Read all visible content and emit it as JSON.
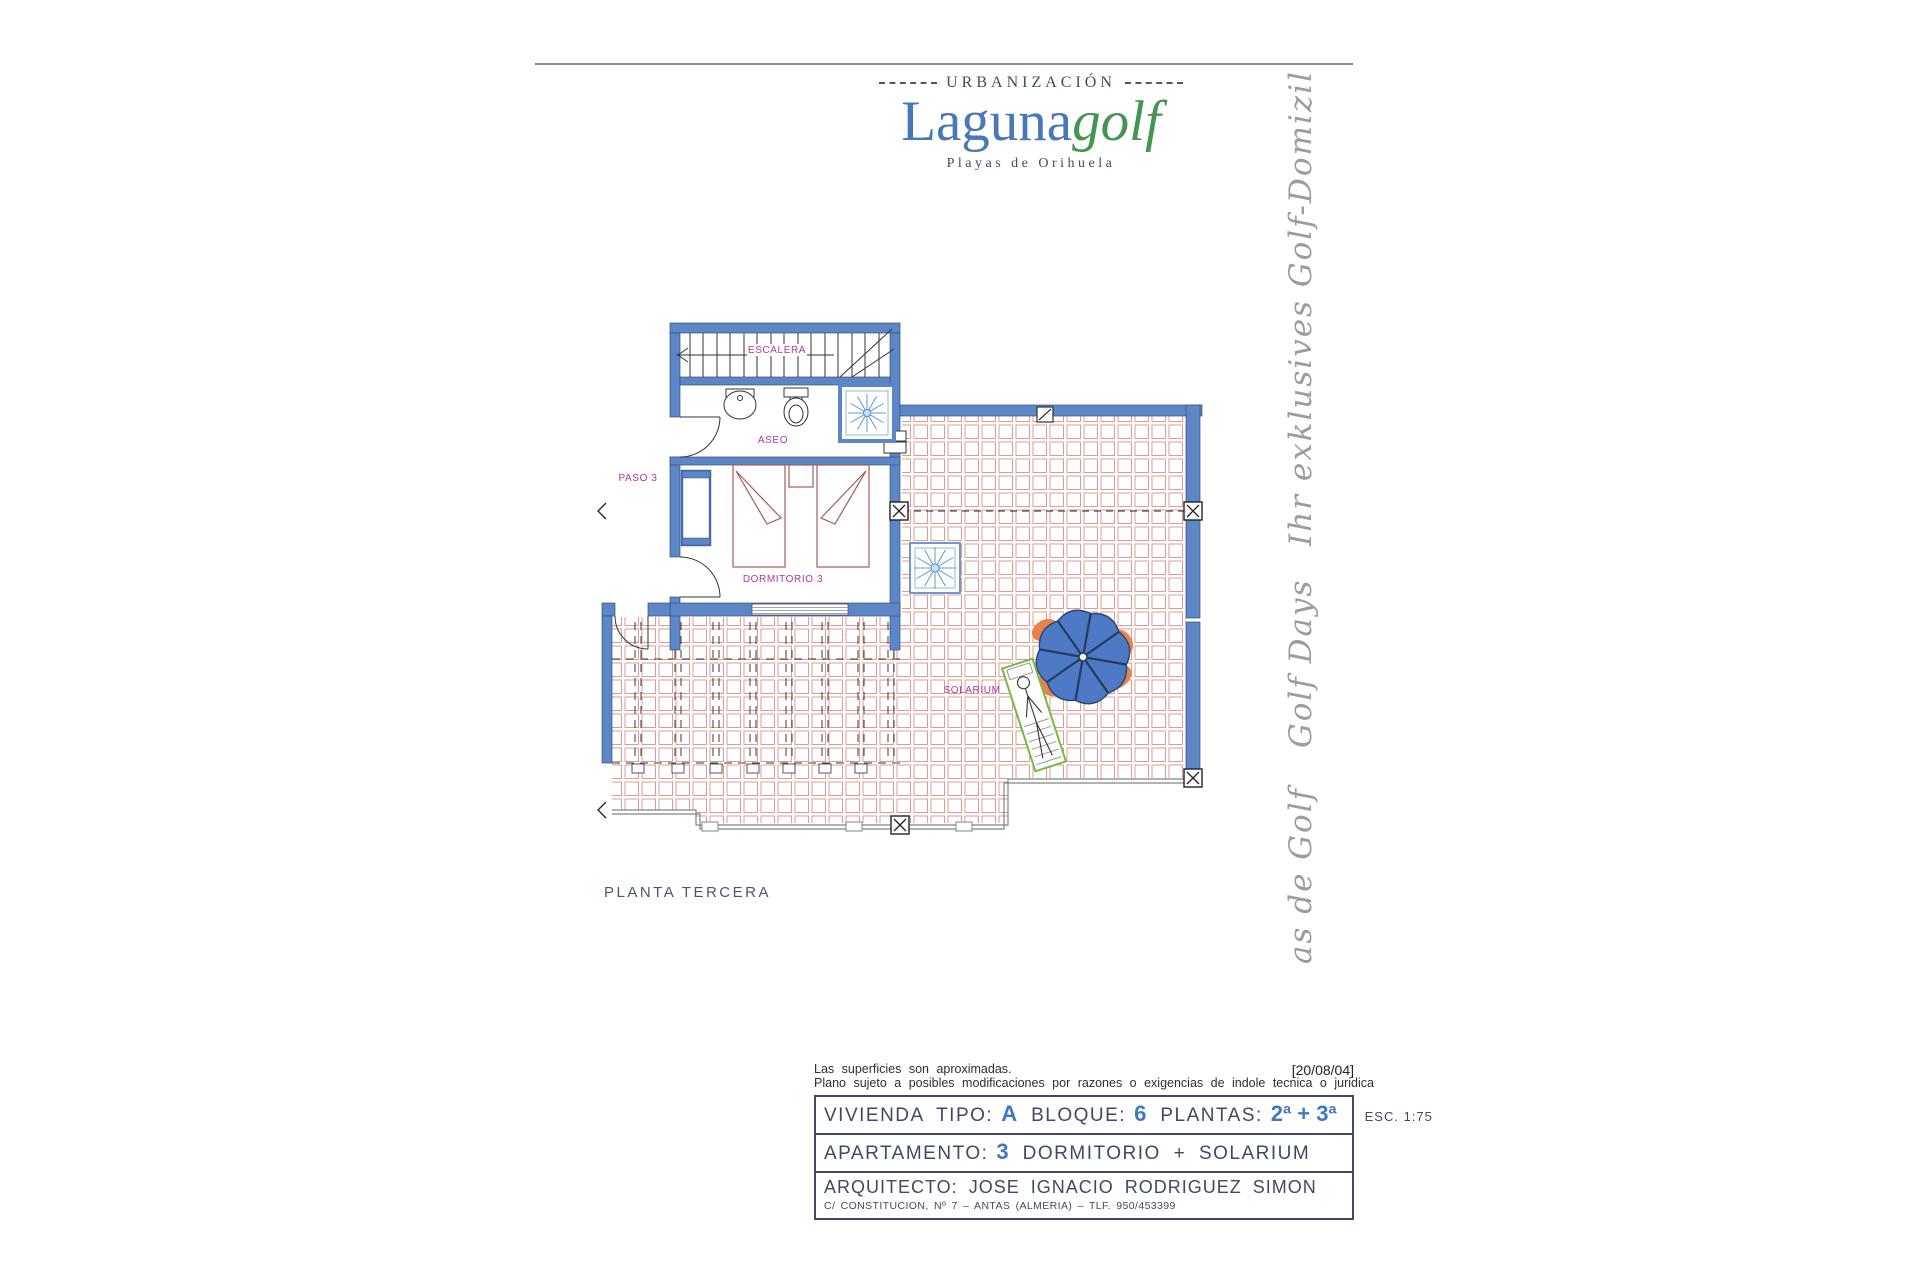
{
  "header": {
    "urbanizacion": "URBANIZACIÓN",
    "brand_blue": "Laguna",
    "brand_green": "golf",
    "subtitle": "Playas de Orihuela",
    "colors": {
      "brand_blue": "#4878b8",
      "brand_green": "#449552",
      "text": "#3f4a62"
    }
  },
  "side_text": {
    "line1": "Ihr exklusives Golf-Domizil",
    "line2": "Golf Days",
    "line3": "as de Golf",
    "color": "#9c9c9c"
  },
  "plan": {
    "labels": {
      "escalera": "ESCALERA",
      "aseo": "ASEO",
      "paso": "PASO 3",
      "dormitorio": "DORMITORIO 3",
      "solarium": "SOLARIUM"
    },
    "caption": "PLANTA TERCERA",
    "colors": {
      "wall_blue": "#5b87c6",
      "tile_salmon": "#dd9c8c",
      "label_magenta": "#a8399f",
      "furniture_red": "#a85a5a",
      "umbrella_blue": "#4e79c4",
      "lounger_green": "#7ab648",
      "chair_orange": "#e8834e"
    }
  },
  "footer": {
    "date_stamp": "[20/08/04]",
    "note1": "Las superficies son aproximadas.",
    "note2": "Plano sujeto a posibles modificaciones por razones o exigencias de indole tecnica o juridica",
    "row1": {
      "label1": "VIVIENDA TIPO:",
      "value1": "A",
      "label2": "BLOQUE:",
      "value2": "6",
      "label3": "PLANTAS:",
      "value3": "2ª + 3ª",
      "scale": "ESC.  1:75"
    },
    "row2": {
      "label": "APARTAMENTO:",
      "value": "3",
      "text": "DORMITORIO  +  SOLARIUM"
    },
    "row3": {
      "label": "ARQUITECTO:",
      "name": "JOSE IGNACIO RODRIGUEZ SIMON",
      "address": "C/ CONSTITUCION, Nº 7 – ANTAS (ALMERIA) – TLF. 950/453399"
    }
  }
}
